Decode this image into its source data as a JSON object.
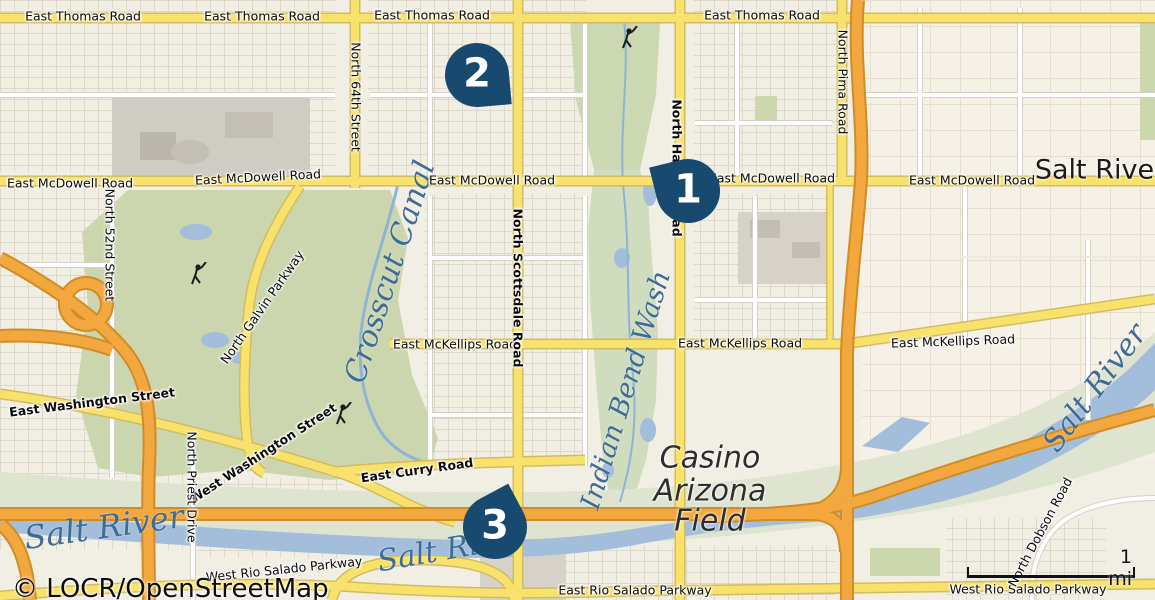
{
  "attribution": "© LOCR/OpenStreetMap",
  "scale_bar": {
    "label": "1 mi"
  },
  "markers": [
    {
      "number": "1"
    },
    {
      "number": "2"
    },
    {
      "number": "3"
    }
  ],
  "roads": {
    "thomas": "East Thomas Road",
    "mcdowell": "East McDowell Road",
    "mckellips": "East McKellips Road",
    "curry": "East Curry Road",
    "e_washington": "East Washington Street",
    "w_washington": "West Washington Street",
    "w_rio_salado": "West Rio Salado Parkway",
    "e_rio_salado": "East Rio Salado Parkway",
    "n64": "North 64th Street",
    "scottsdale": "North Scottsdale Road",
    "hayden": "North Hayden Road",
    "pima": "North Pima Road",
    "n52": "North 52nd Street",
    "priest": "North Priest Drive",
    "galvin": "North Galvin Parkway",
    "dobson": "North Dobson Road"
  },
  "water": {
    "salt_river": "Salt River",
    "crosscut_canal": "Crosscut Canal",
    "indian_bend_wash": "Indian Bend Wash"
  },
  "places": {
    "salt_river_community": "Salt River",
    "casino": {
      "line1": "Casino",
      "line2": "Arizona",
      "line3": "Field"
    }
  },
  "colors": {
    "marker": "#184a6f",
    "freeway": "#f2a83e",
    "arterial": "#f9e26c",
    "water": "#a2bedb",
    "park": "#cbd6ae",
    "water_label": "#3f6c97"
  }
}
